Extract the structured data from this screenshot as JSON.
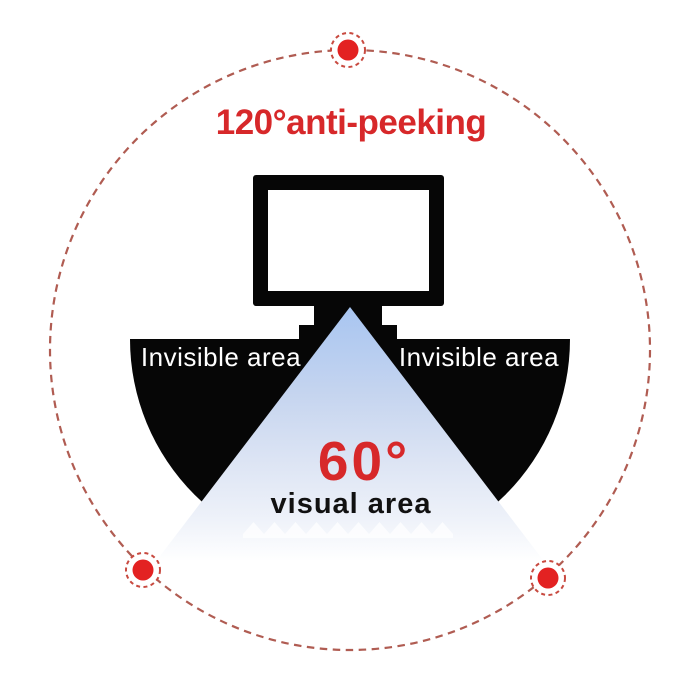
{
  "illustration": {
    "title": "120°anti-peeking",
    "labels": {
      "invisible_left": "Invisible area",
      "invisible_right": "Invisible area",
      "visual_angle": "60°",
      "visual_area": "visual area"
    },
    "colors": {
      "accent_red": "#d7282a",
      "dot_red": "#e32222",
      "dashed_line": "#b05c52",
      "dot_ring": "#c84a40",
      "cone_blue_top": "#a8c5f1",
      "shape_black": "#060606",
      "invisible_text": "#ffffff",
      "visual_text": "#111111"
    }
  }
}
